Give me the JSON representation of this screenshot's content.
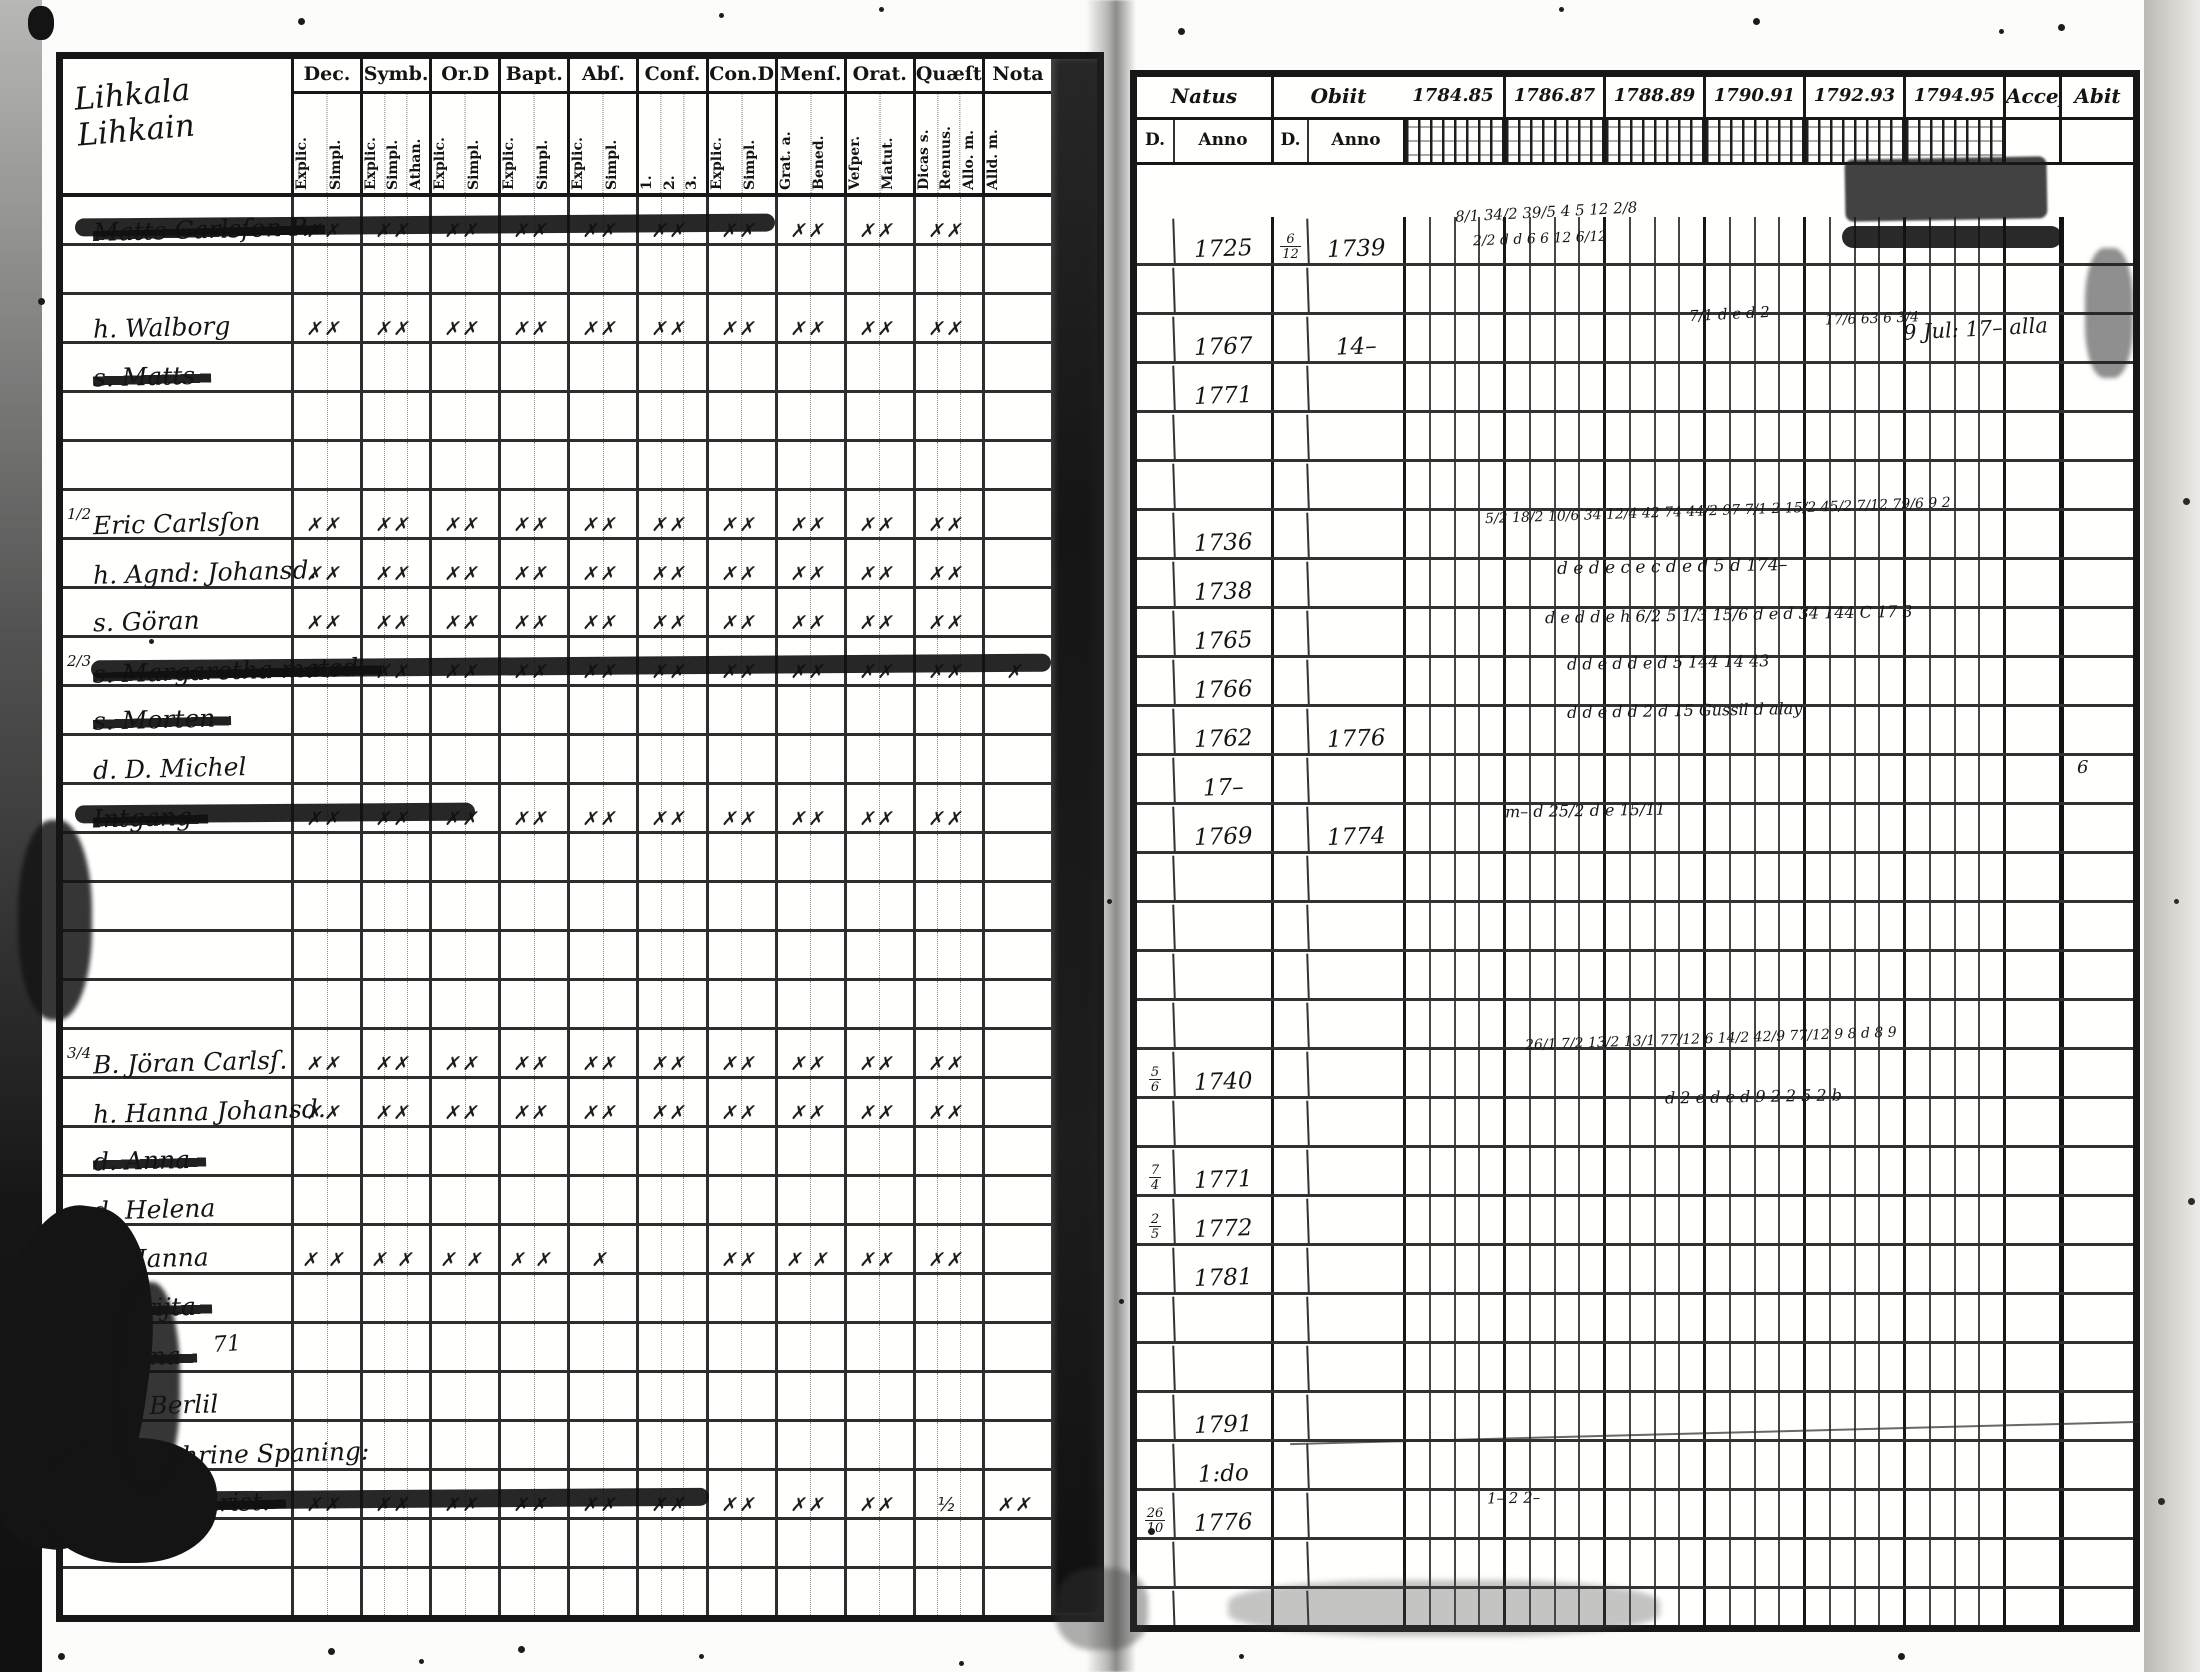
{
  "document": {
    "kind": "scanned parish communion register spread",
    "left_page": {
      "title_lines": [
        "Lihkala",
        "Lihkain"
      ],
      "columns": [
        {
          "label": "Dec.",
          "subs": [
            "Explic.",
            "Simpl."
          ]
        },
        {
          "label": "Symb.",
          "subs": [
            "Explic.",
            "Simpl.",
            "Athan."
          ]
        },
        {
          "label": "Or.D",
          "subs": [
            "Explic.",
            "Simpl."
          ]
        },
        {
          "label": "Bapt.",
          "subs": [
            "Explic.",
            "Simpl."
          ]
        },
        {
          "label": "Abſ.",
          "subs": [
            "Explic.",
            "Simpl."
          ]
        },
        {
          "label": "Conf.",
          "subs": [
            "1.",
            "2.",
            "3."
          ]
        },
        {
          "label": "Con.D",
          "subs": [
            "Explic.",
            "Simpl."
          ]
        },
        {
          "label": "Menſ.",
          "subs": [
            "Grat. a.",
            "Bened."
          ]
        },
        {
          "label": "Orat.",
          "subs": [
            "Veſper.",
            "Matut."
          ]
        },
        {
          "label": "Quæſt.",
          "subs": [
            "Dicas s.",
            "Renuus.",
            "Allo. m."
          ]
        },
        {
          "label": "Nota",
          "subs": [
            "Alld. m."
          ]
        }
      ],
      "rows": [
        {
          "margin": "",
          "name": "Matts Carlsſon P.",
          "struck": true,
          "smear": "a",
          "marks": [
            "✗✗",
            "✗✗",
            "✗✗",
            "✗✗",
            "✗✗",
            "✗✗",
            "✗✗",
            "✗✗",
            "✗✗",
            "✗✗",
            ""
          ]
        },
        {
          "margin": "",
          "name": "",
          "struck": false,
          "marks": [
            "",
            "",
            "",
            "",
            "",
            "",
            "",
            "",
            "",
            "",
            ""
          ]
        },
        {
          "margin": "",
          "name": "h. Walborg",
          "struck": false,
          "marks": [
            "✗✗",
            "✗✗",
            "✗✗",
            "✗✗",
            "✗✗",
            "✗✗",
            "✗✗",
            "✗✗",
            "✗✗",
            "✗✗",
            ""
          ]
        },
        {
          "margin": "",
          "name": "s. Matts",
          "struck": true,
          "marks": [
            "",
            "",
            "",
            "",
            "",
            "",
            "",
            "",
            "",
            "",
            ""
          ]
        },
        {
          "margin": "",
          "name": "",
          "struck": false,
          "marks": [
            "",
            "",
            "",
            "",
            "",
            "",
            "",
            "",
            "",
            "",
            ""
          ]
        },
        {
          "margin": "",
          "name": "",
          "struck": false,
          "marks": [
            "",
            "",
            "",
            "",
            "",
            "",
            "",
            "",
            "",
            "",
            ""
          ]
        },
        {
          "margin": "1/2",
          "name": "Eric Carlsſon",
          "struck": false,
          "marks": [
            "✗✗",
            "✗✗",
            "✗✗",
            "✗✗",
            "✗✗",
            "✗✗",
            "✗✗",
            "✗✗",
            "✗✗",
            "✗✗",
            ""
          ]
        },
        {
          "margin": "",
          "name": "h. Agnd: Johansd.",
          "struck": false,
          "marks": [
            "✗✗",
            "✗✗",
            "✗✗",
            "✗✗",
            "✗✗",
            "✗✗",
            "✗✗",
            "✗✗",
            "✗✗",
            "✗✗",
            ""
          ]
        },
        {
          "margin": "",
          "name": "s. Göran",
          "struck": false,
          "marks": [
            "✗✗",
            "✗✗",
            "✗✗",
            "✗✗",
            "✗✗",
            "✗✗",
            "✗✗",
            "✗✗",
            "✗✗",
            "✗✗",
            ""
          ]
        },
        {
          "margin": "2/3",
          "name": "s. Margaretha matsd.",
          "struck": true,
          "smear": "b",
          "marks": [
            "✗✗",
            "✗✗",
            "✗✗",
            "✗✗",
            "✗✗",
            "✗✗",
            "✗✗",
            "✗✗",
            "✗✗",
            "✗✗",
            "✗"
          ]
        },
        {
          "margin": "",
          "name": "s. Morten",
          "struck": true,
          "marks": [
            "",
            "",
            "",
            "",
            "",
            "",
            "",
            "",
            "",
            "",
            ""
          ]
        },
        {
          "margin": "",
          "name": "d. D. Michel",
          "struck": false,
          "marks": [
            "",
            "",
            "",
            "",
            "",
            "",
            "",
            "",
            "",
            "",
            ""
          ]
        },
        {
          "margin": "",
          "name": "Intgang",
          "struck": true,
          "smear": "d",
          "marks": [
            "✗✗",
            "✗✗",
            "✗✗",
            "✗✗",
            "✗✗",
            "✗✗",
            "✗✗",
            "✗✗",
            "✗✗",
            "✗✗",
            ""
          ]
        },
        {
          "margin": "",
          "name": "",
          "struck": false,
          "marks": [
            "",
            "",
            "",
            "",
            "",
            "",
            "",
            "",
            "",
            "",
            ""
          ]
        },
        {
          "margin": "",
          "name": "",
          "struck": false,
          "marks": [
            "",
            "",
            "",
            "",
            "",
            "",
            "",
            "",
            "",
            "",
            ""
          ]
        },
        {
          "margin": "",
          "name": "",
          "struck": false,
          "marks": [
            "",
            "",
            "",
            "",
            "",
            "",
            "",
            "",
            "",
            "",
            ""
          ]
        },
        {
          "margin": "",
          "name": "",
          "struck": false,
          "marks": [
            "",
            "",
            "",
            "",
            "",
            "",
            "",
            "",
            "",
            "",
            ""
          ]
        },
        {
          "margin": "3/4",
          "name": "B. Jöran Carlsſ.",
          "struck": false,
          "marks": [
            "✗✗",
            "✗✗",
            "✗✗",
            "✗✗",
            "✗✗",
            "✗✗",
            "✗✗",
            "✗✗",
            "✗✗",
            "✗✗",
            ""
          ]
        },
        {
          "margin": "",
          "name": "h. Hanna Johansd.",
          "struck": false,
          "marks": [
            "✗✗",
            "✗✗",
            "✗✗",
            "✗✗",
            "✗✗",
            "✗✗",
            "✗✗",
            "✗✗",
            "✗✗",
            "✗✗",
            ""
          ]
        },
        {
          "margin": "",
          "name": "d. Anna",
          "struck": true,
          "marks": [
            "",
            "",
            "",
            "",
            "",
            "",
            "",
            "",
            "",
            "",
            ""
          ]
        },
        {
          "margin": "",
          "name": "d. Helena",
          "struck": false,
          "marks": [
            "",
            "",
            "",
            "",
            "",
            "",
            "",
            "",
            "",
            "",
            ""
          ]
        },
        {
          "margin": "",
          "name": "d. Hanna",
          "struck": false,
          "marks": [
            "✗ ✗",
            "✗ ✗",
            "✗ ✗",
            "✗ ✗",
            "✗",
            "",
            "✗✗",
            "✗ ✗",
            "✗✗",
            "✗✗",
            ""
          ]
        },
        {
          "margin": "",
          "name": "d. Brijta",
          "struck": true,
          "marks": [
            "",
            "",
            "",
            "",
            "",
            "",
            "",
            "",
            "",
            "",
            ""
          ]
        },
        {
          "margin": "",
          "name": "d. Jana",
          "struck": true,
          "marks": [
            "",
            "",
            "",
            "",
            "",
            "",
            "",
            "",
            "",
            "",
            ""
          ]
        },
        {
          "margin": "",
          "name": "Son Berlil",
          "struck": false,
          "marks": [
            "",
            "",
            "",
            "",
            "",
            "",
            "",
            "",
            "",
            "",
            ""
          ]
        },
        {
          "margin": "",
          "name": "ex. Cathrine Spaning:",
          "struck": false,
          "marks": [
            "",
            "",
            "",
            "",
            "",
            "",
            "",
            "",
            "",
            "",
            ""
          ]
        },
        {
          "margin": "",
          "name": "Twista Christ.",
          "struck": true,
          "smear": "c",
          "marks": [
            "✗✗",
            "✗✗",
            "✗✗",
            "✗✗",
            "✗✗",
            "✗✗",
            "✗✗",
            "✗✗",
            "✗✗",
            "½",
            "✗✗"
          ]
        },
        {
          "margin": "",
          "name": "",
          "struck": false,
          "marks": [
            "",
            "",
            "",
            "",
            "",
            "",
            "",
            "",
            "",
            "",
            ""
          ]
        },
        {
          "margin": "",
          "name": "",
          "struck": false,
          "marks": [
            "",
            "",
            "",
            "",
            "",
            "",
            "",
            "",
            "",
            "",
            ""
          ]
        }
      ],
      "notes": [
        {
          "text": "71",
          "x": 150,
          "y": 1273,
          "size": 22,
          "rot": -4
        }
      ]
    },
    "right_page": {
      "header": {
        "natus": "Natus",
        "obiit": "Obiit",
        "sub_d": "D.",
        "sub_anno": "Anno",
        "years": [
          "1784.85",
          "1786.87",
          "1788.89",
          "1790.91",
          "1792.93",
          "1794.95"
        ],
        "accessit": "Acceſ",
        "abiit": "Abit"
      },
      "rows": [
        {
          "natus_d": "",
          "natus_anno": "1725",
          "obiit_d": "6/12",
          "obiit_anno": "1739"
        },
        {
          "natus_d": "",
          "natus_anno": "",
          "obiit_d": "",
          "obiit_anno": ""
        },
        {
          "natus_d": "",
          "natus_anno": "1767",
          "obiit_d": "",
          "obiit_anno": "14–"
        },
        {
          "natus_d": "",
          "natus_anno": "1771",
          "obiit_d": "",
          "obiit_anno": ""
        },
        {
          "natus_d": "",
          "natus_anno": "",
          "obiit_d": "",
          "obiit_anno": ""
        },
        {
          "natus_d": "",
          "natus_anno": "",
          "obiit_d": "",
          "obiit_anno": ""
        },
        {
          "natus_d": "",
          "natus_anno": "1736",
          "obiit_d": "",
          "obiit_anno": ""
        },
        {
          "natus_d": "",
          "natus_anno": "1738",
          "obiit_d": "",
          "obiit_anno": ""
        },
        {
          "natus_d": "",
          "natus_anno": "1765",
          "obiit_d": "",
          "obiit_anno": ""
        },
        {
          "natus_d": "",
          "natus_anno": "1766",
          "obiit_d": "",
          "obiit_anno": ""
        },
        {
          "natus_d": "",
          "natus_anno": "1762",
          "obiit_d": "",
          "obiit_anno": "1776"
        },
        {
          "natus_d": "",
          "natus_anno": "17–",
          "obiit_d": "",
          "obiit_anno": ""
        },
        {
          "natus_d": "",
          "natus_anno": "1769",
          "obiit_d": "",
          "obiit_anno": "1774"
        },
        {
          "natus_d": "",
          "natus_anno": "",
          "obiit_d": "",
          "obiit_anno": ""
        },
        {
          "natus_d": "",
          "natus_anno": "",
          "obiit_d": "",
          "obiit_anno": ""
        },
        {
          "natus_d": "",
          "natus_anno": "",
          "obiit_d": "",
          "obiit_anno": ""
        },
        {
          "natus_d": "",
          "natus_anno": "",
          "obiit_d": "",
          "obiit_anno": ""
        },
        {
          "natus_d": "5/6",
          "natus_anno": "1740",
          "obiit_d": "",
          "obiit_anno": ""
        },
        {
          "natus_d": "",
          "natus_anno": "",
          "obiit_d": "",
          "obiit_anno": ""
        },
        {
          "natus_d": "7/4",
          "natus_anno": "1771",
          "obiit_d": "",
          "obiit_anno": ""
        },
        {
          "natus_d": "2/5",
          "natus_anno": "1772",
          "obiit_d": "",
          "obiit_anno": ""
        },
        {
          "natus_d": "",
          "natus_anno": "1781",
          "obiit_d": "",
          "obiit_anno": ""
        },
        {
          "natus_d": "",
          "natus_anno": "",
          "obiit_d": "",
          "obiit_anno": ""
        },
        {
          "natus_d": "",
          "natus_anno": "",
          "obiit_d": "",
          "obiit_anno": ""
        },
        {
          "natus_d": "",
          "natus_anno": "1791",
          "obiit_d": "",
          "obiit_anno": ""
        },
        {
          "natus_d": "",
          "natus_anno": "1:do",
          "obiit_d": "",
          "obiit_anno": ""
        },
        {
          "natus_d": "26/10",
          "natus_anno": "1776",
          "obiit_d": "",
          "obiit_anno": ""
        },
        {
          "natus_d": "",
          "natus_anno": "",
          "obiit_d": "",
          "obiit_anno": ""
        },
        {
          "natus_d": "",
          "natus_anno": "",
          "obiit_d": "",
          "obiit_anno": ""
        }
      ],
      "notes": [
        {
          "text": "8/1  34/2 39/5  4 5    12 2/8",
          "x": 318,
          "y": 44,
          "size": 15,
          "rot": -3
        },
        {
          "text": "2/2  d d  6 6    12 6/12",
          "x": 336,
          "y": 72,
          "size": 14,
          "rot": -2
        },
        {
          "text": "7/1 d e d 2",
          "x": 552,
          "y": 146,
          "size": 15,
          "rot": -3
        },
        {
          "text": "17/6 63 6 3/4",
          "x": 688,
          "y": 152,
          "size": 14,
          "rot": -2
        },
        {
          "text": "9 Jul: 17– alla",
          "x": 766,
          "y": 158,
          "size": 21,
          "rot": -3
        },
        {
          "text": "5/2 18/2 10/6  34 12/4 42  74 44/2 97  7/1 2  15/2 45/2 7/12   79/6  9 2",
          "x": 348,
          "y": 344,
          "size": 14,
          "rot": -2
        },
        {
          "text": "d e d e  c e  c d e d   5 d    174–",
          "x": 420,
          "y": 398,
          "size": 17,
          "rot": -1
        },
        {
          "text": "d e d d e  h 6/2   5 1/3 15/6  d e d  34   144    C 17 3",
          "x": 408,
          "y": 446,
          "size": 16,
          "rot": -1
        },
        {
          "text": "d   d   e d   d e d    5    144    14 43",
          "x": 430,
          "y": 494,
          "size": 16,
          "rot": -1
        },
        {
          "text": "d d  e d    d  2    d 15  Gussil d alay",
          "x": 430,
          "y": 542,
          "size": 16,
          "rot": -1
        },
        {
          "text": "6",
          "x": 940,
          "y": 598,
          "size": 18,
          "rot": 0
        },
        {
          "text": "m– d 25/2 d e    15/11",
          "x": 368,
          "y": 642,
          "size": 16,
          "rot": -1
        },
        {
          "text": "26/1 7/2 13/2  13/1 77/12  6 14/2 42/9 77/12  9 8    d 8 9",
          "x": 388,
          "y": 872,
          "size": 14,
          "rot": -2
        },
        {
          "text": "d  2  e d e   d 9 2 2    5 2    b",
          "x": 528,
          "y": 928,
          "size": 16,
          "rot": -1
        },
        {
          "text": "1– 2  2–",
          "x": 350,
          "y": 1330,
          "size": 15,
          "rot": -1
        }
      ]
    }
  }
}
